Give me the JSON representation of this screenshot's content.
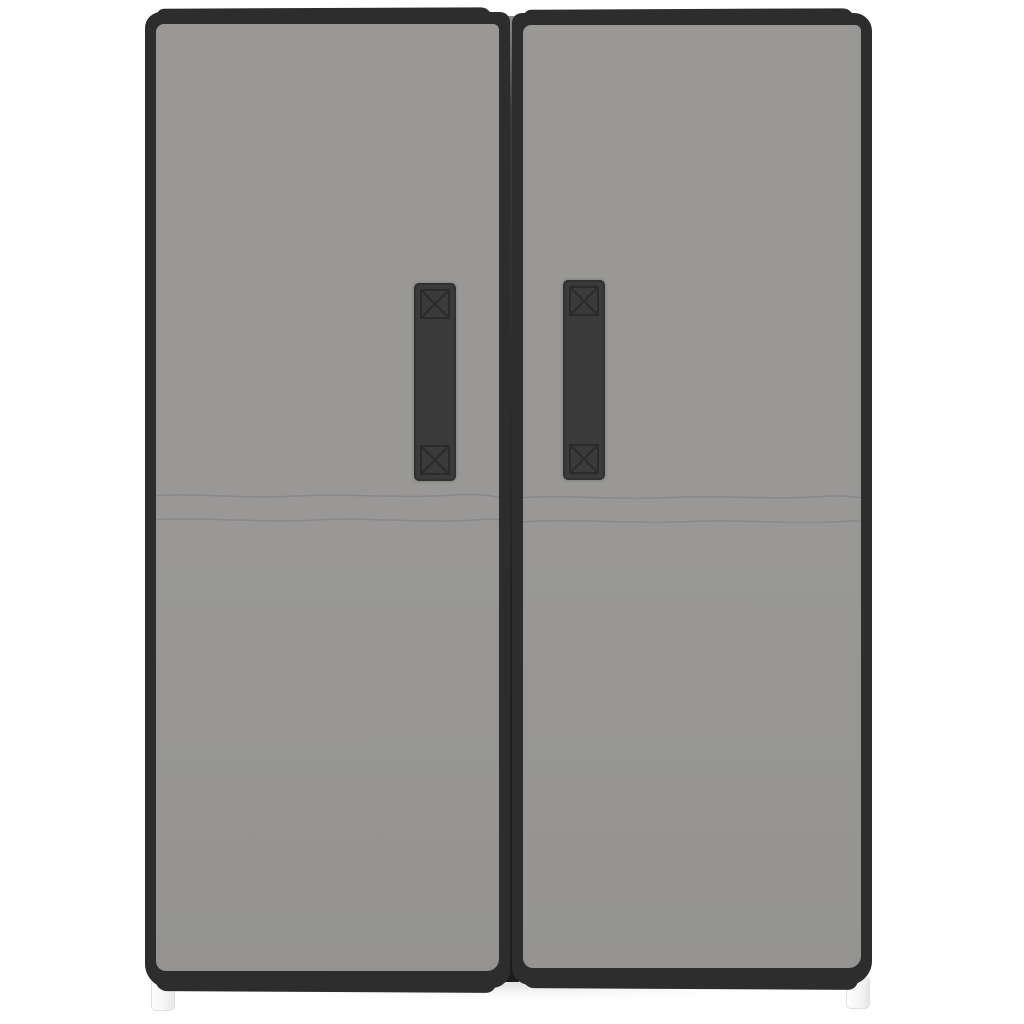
{
  "scene": {
    "description": "Product photo of a grey fabric wardrobe with two doors framed in black trim, each door with a vertical black strap handle stitched with cross boxes, two faint horizontal seam lines across both doors, a dark slot between the doors, and small white plastic feet, on a plain white background",
    "object_label": "two-door grey fabric wardrobe"
  },
  "colors": {
    "background": "#ffffff",
    "fabric": "#999896",
    "fabric_shade": "#949391",
    "seam": "#85848a",
    "trim": "#2d2d2d",
    "trim_dark": "#222222",
    "handle": "#3a3a3a",
    "stitch": "#2a2a2a",
    "foot": "#f5f5f5",
    "foot_border": "#e0e0e0",
    "shadow": "rgba(0,0,0,0.16)"
  }
}
